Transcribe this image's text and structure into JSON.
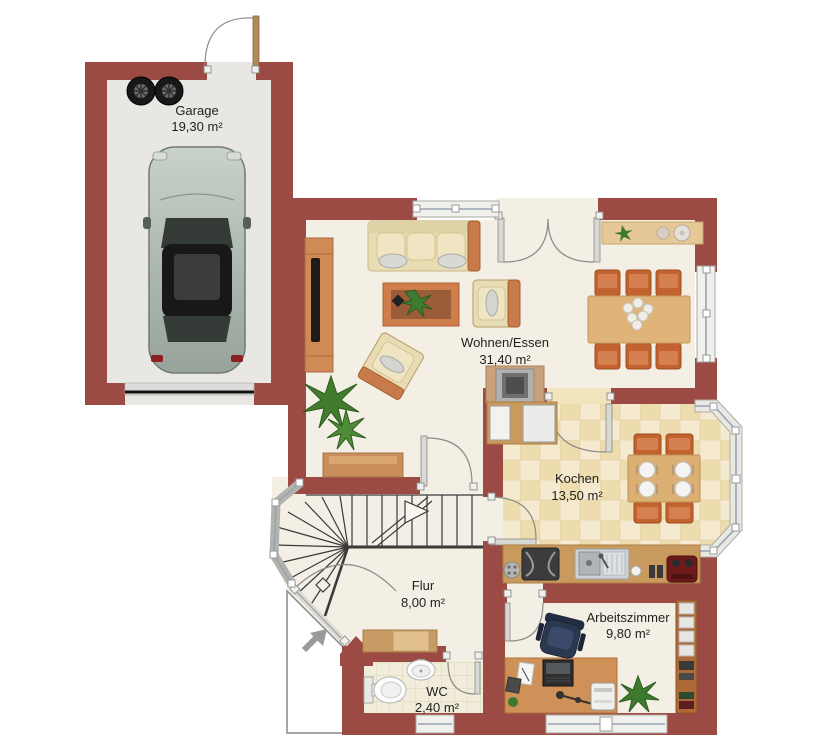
{
  "rooms": [
    {
      "id": "garage",
      "name": "Garage",
      "area": "19,30 m²"
    },
    {
      "id": "wohnen-essen",
      "name": "Wohnen/Essen",
      "area": "31,40 m²"
    },
    {
      "id": "kochen",
      "name": "Kochen",
      "area": "13,50 m²"
    },
    {
      "id": "flur",
      "name": "Flur",
      "area": "8,00 m²"
    },
    {
      "id": "wc",
      "name": "WC",
      "area": "2,40 m²"
    },
    {
      "id": "arbeitszimmer",
      "name": "Arbeitszimmer",
      "area": "9,80 m²"
    }
  ],
  "colors": {
    "wall": "#9c4b44",
    "floor_cream": "#f4efe5",
    "kitchen_tile": "#f1e3b8",
    "wc_tile": "#f1edda",
    "garage_floor": "#e8e7e4",
    "wood_orange": "#cf8a55",
    "wood_light": "#e6c896",
    "chair_orange": "#c2622f",
    "window_glass": "#98a2b6",
    "plant_green": "#3e7a2e",
    "office_chair": "#2c3850",
    "car_body": "#b2bdb6"
  },
  "furniture": {
    "garage": [
      "car",
      "spare-tires",
      "garage-door",
      "entry-door"
    ],
    "wohnen_essen": [
      "sofa",
      "coffee-table",
      "armchair",
      "armchair",
      "tv-lowboard",
      "palm-plant",
      "fireplace-stove",
      "dining-table",
      "six-dining-chairs",
      "sideboard",
      "sideboard-with-plant"
    ],
    "kochen": [
      "fridge",
      "oven",
      "kitchen-counter",
      "cooktop",
      "double-sink",
      "coffee-machine",
      "kitchen-table",
      "four-chairs",
      "bay-window"
    ],
    "flur": [
      "winder-staircase",
      "sideboard",
      "entrance-door",
      "entrance-arrow"
    ],
    "wc": [
      "toilet",
      "wash-basin"
    ],
    "arbeitszimmer": [
      "desk",
      "office-chair",
      "printer",
      "laptop",
      "bookshelf",
      "plant"
    ]
  }
}
